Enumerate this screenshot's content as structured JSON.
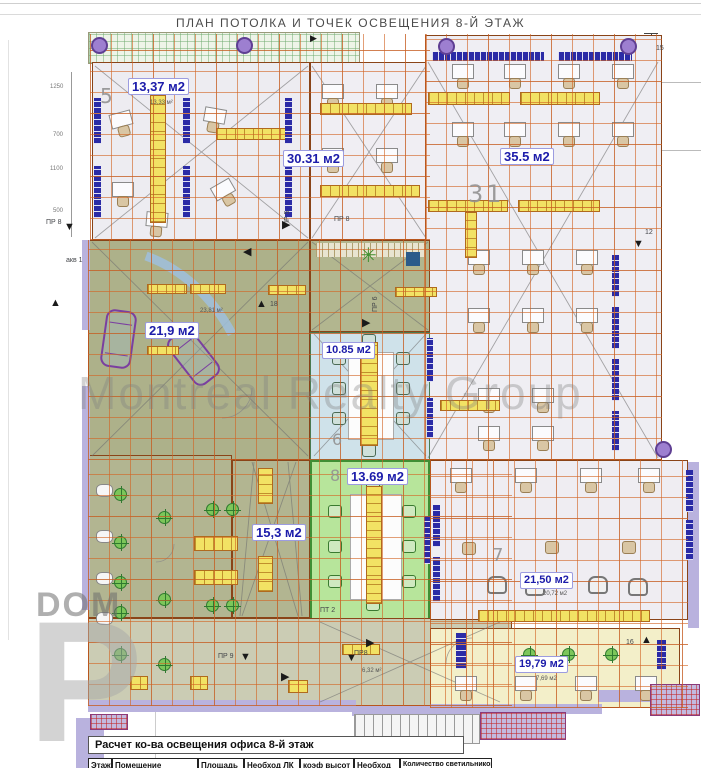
{
  "title": "ПЛАН ПОТОЛКА И ТОЧЕК ОСВЕЩЕНИЯ 8-Й ЭТАЖ",
  "labels": {
    "r5_num": "5",
    "r5_area": "13,37 м2",
    "r30_area": "30.31 м2",
    "r31_num": "31",
    "r31_area": "35.5 м2",
    "car_area": "21,9 м2",
    "r6_num": "6",
    "r6_area": "10.85 м2",
    "r8_num": "8",
    "r8_area": "13.69 м2",
    "corridor_area": "15,3 м2",
    "r7_num": "7",
    "r7_area": "21,50 м2",
    "r7_sub": "20,72 м2",
    "r19_area": "19,79 м2",
    "r19_sub": "7,69 м2"
  },
  "markers": {
    "pr8_left": "ПР 8",
    "akv": "акв 1",
    "pr5": "ПР 5",
    "pr8_mid": "ПР 8",
    "pr6": "ПР 6",
    "pr9": "ПР 9",
    "pr8_bottom": "ПР8",
    "pt2": "ПТ 2",
    "m12": "12",
    "m15": "15",
    "m16": "16",
    "m18": "18"
  },
  "small_areas": {
    "s1": "13,33 м²",
    "s2": "23,81 м²",
    "s3": "6,32 м²"
  },
  "dimensions": {
    "d1": "1250",
    "d2": "700",
    "d3": "1100",
    "d4": "500"
  },
  "watermarks": {
    "brand": "Montreal Realty Group",
    "dom": "DOM",
    "letter": "P"
  },
  "table": {
    "title": "Расчет ко-ва освещения офиса  8-й этаж",
    "headers": [
      "Этаж",
      "Помещение",
      "Площадь",
      "Необход ЛК",
      "коэф высот",
      "Необход",
      "Количество светильников"
    ]
  },
  "colors": {
    "grid_orange": "#d2642a",
    "light_fixture_yellow": "#f2e264",
    "window_blue": "#2b2ba6",
    "room_green": "#b7e59b",
    "room_blue": "#cfe2ea",
    "olive_zone": "#afb38c",
    "wall_lavender": "#b9b2de",
    "label_blue": "#1c1caa"
  }
}
